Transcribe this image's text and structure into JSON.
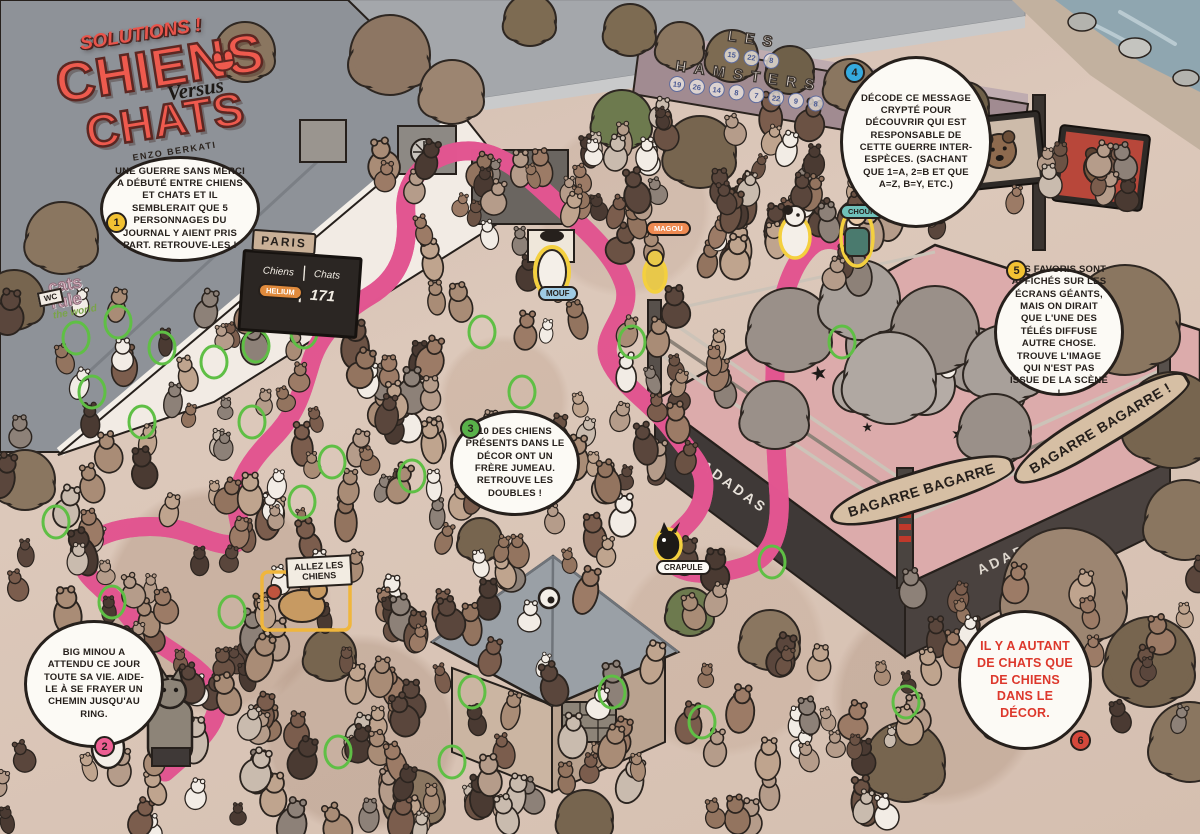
{
  "title": {
    "kicker": "SOLUTIONS !",
    "line1": "CHIENS",
    "versus": "Versus",
    "line2": "CHATS",
    "author": "ENZO BERKATI"
  },
  "bubbles": [
    {
      "num": "1",
      "color": "#f2c233",
      "text": "UNE GUERRE SANS MERCI A DÉBUTÉ ENTRE CHIENS ET CHATS ET IL SEMBLERAIT QUE 5 PERSONNAGES DU JOURNAL Y AIENT PRIS PART. RETROUVE-LES !"
    },
    {
      "num": "2",
      "color": "#ee5e93",
      "text": "BIG MINOU A ATTENDU CE JOUR TOUTE SA VIE. AIDE-LE À SE FRAYER UN CHEMIN JUSQU'AU RING."
    },
    {
      "num": "3",
      "color": "#59b14a",
      "text": "10 DES CHIENS PRÉSENTS DANS LE DÉCOR ONT UN FRÈRE JUMEAU. RETROUVE LES DOUBLES !"
    },
    {
      "num": "4",
      "color": "#35aade",
      "text": "DÉCODE CE MESSAGE CRYPTÉ POUR DÉCOUVRIR QUI EST RESPONSABLE DE CETTE GUERRE INTER-ESPÈCES. (SACHANT QUE 1=A, 2=B ET QUE A=Z, B=Y, ETC.)"
    },
    {
      "num": "5",
      "color": "#f2c233",
      "text": "LES FAVORIS SONT AFFICHÉS SUR LES ÉCRANS GÉANTS, MAIS ON DIRAIT QUE L'UNE DES TÉLÉS DIFFUSE AUTRE CHOSE. TROUVE L'IMAGE QUI N'EST PAS ISSUE DE LA SCÈNE !"
    },
    {
      "num": "6",
      "color": "#d4483b",
      "text": "IL Y A AUTANT DE CHATS QUE DE CHIENS DANS LE DÉCOR."
    }
  ],
  "scoreboard": {
    "place": "PARIS",
    "col_left": "Chiens",
    "col_right": "Chats",
    "score_left": "171",
    "score_right": "171",
    "divider": "|"
  },
  "signs": {
    "allez": "ALLEZ LES CHIENS",
    "bagarre_left": "BAGARRE BAGARRE",
    "bagarre_right": "BAGARRE BAGARRE !",
    "ring_brand": "ADADAS",
    "wc": "WC"
  },
  "graffiti": {
    "word1": "LES",
    "word2": "HAMSTERS",
    "numbers1": [
      "15",
      "22",
      "8"
    ],
    "numbers2": [
      "19",
      "26",
      "14",
      "8",
      "7",
      "22",
      "9",
      "8"
    ],
    "left_line1": "cats",
    "left_line2": "rule",
    "left_line3": "the world"
  },
  "character_labels": [
    {
      "name": "MOUF"
    },
    {
      "name": "CRAPULE"
    },
    {
      "name": "MAGOU"
    },
    {
      "name": "CHOUKI"
    },
    {
      "name": "HELIUM"
    }
  ],
  "colors": {
    "path_pink": "#ee679d",
    "path_pink_dark": "#e15590",
    "title_red": "#ee5a4e",
    "answer_red": "#dd382c",
    "twin_highlight_green": "#5fbf45",
    "character_highlight_yellow": "#f4d03f",
    "ground": "#d9c4b6"
  }
}
